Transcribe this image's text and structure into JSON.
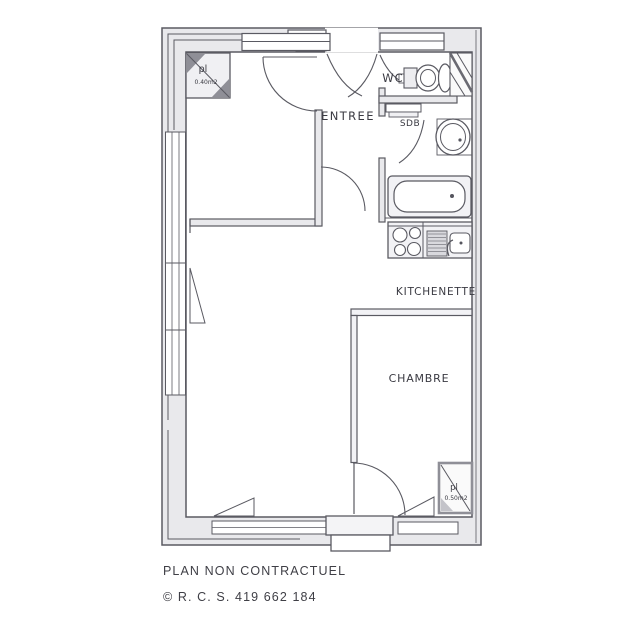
{
  "plan": {
    "labels": {
      "entree": "ENTREE",
      "wc": "WC",
      "sdb": "SDB",
      "kitchenette": "KITCHENETTE",
      "chambre": "CHAMBRE"
    },
    "closets": {
      "entry": {
        "label": "pl",
        "area": "0.40m2"
      },
      "chambre": {
        "label": "pl",
        "area": "0.50m2"
      }
    },
    "fixtures": [
      "toilet",
      "washbasin",
      "bathtub",
      "stove",
      "kitchen-sink",
      "duct-shaft"
    ],
    "colors": {
      "line": "#5a5a62",
      "wall_fill": "#e9e9ec",
      "text": "#3a3a42",
      "background": "#ffffff"
    }
  },
  "footer": {
    "line1": "PLAN NON CONTRACTUEL",
    "line2": "© R. C. S. 419 662 184"
  }
}
